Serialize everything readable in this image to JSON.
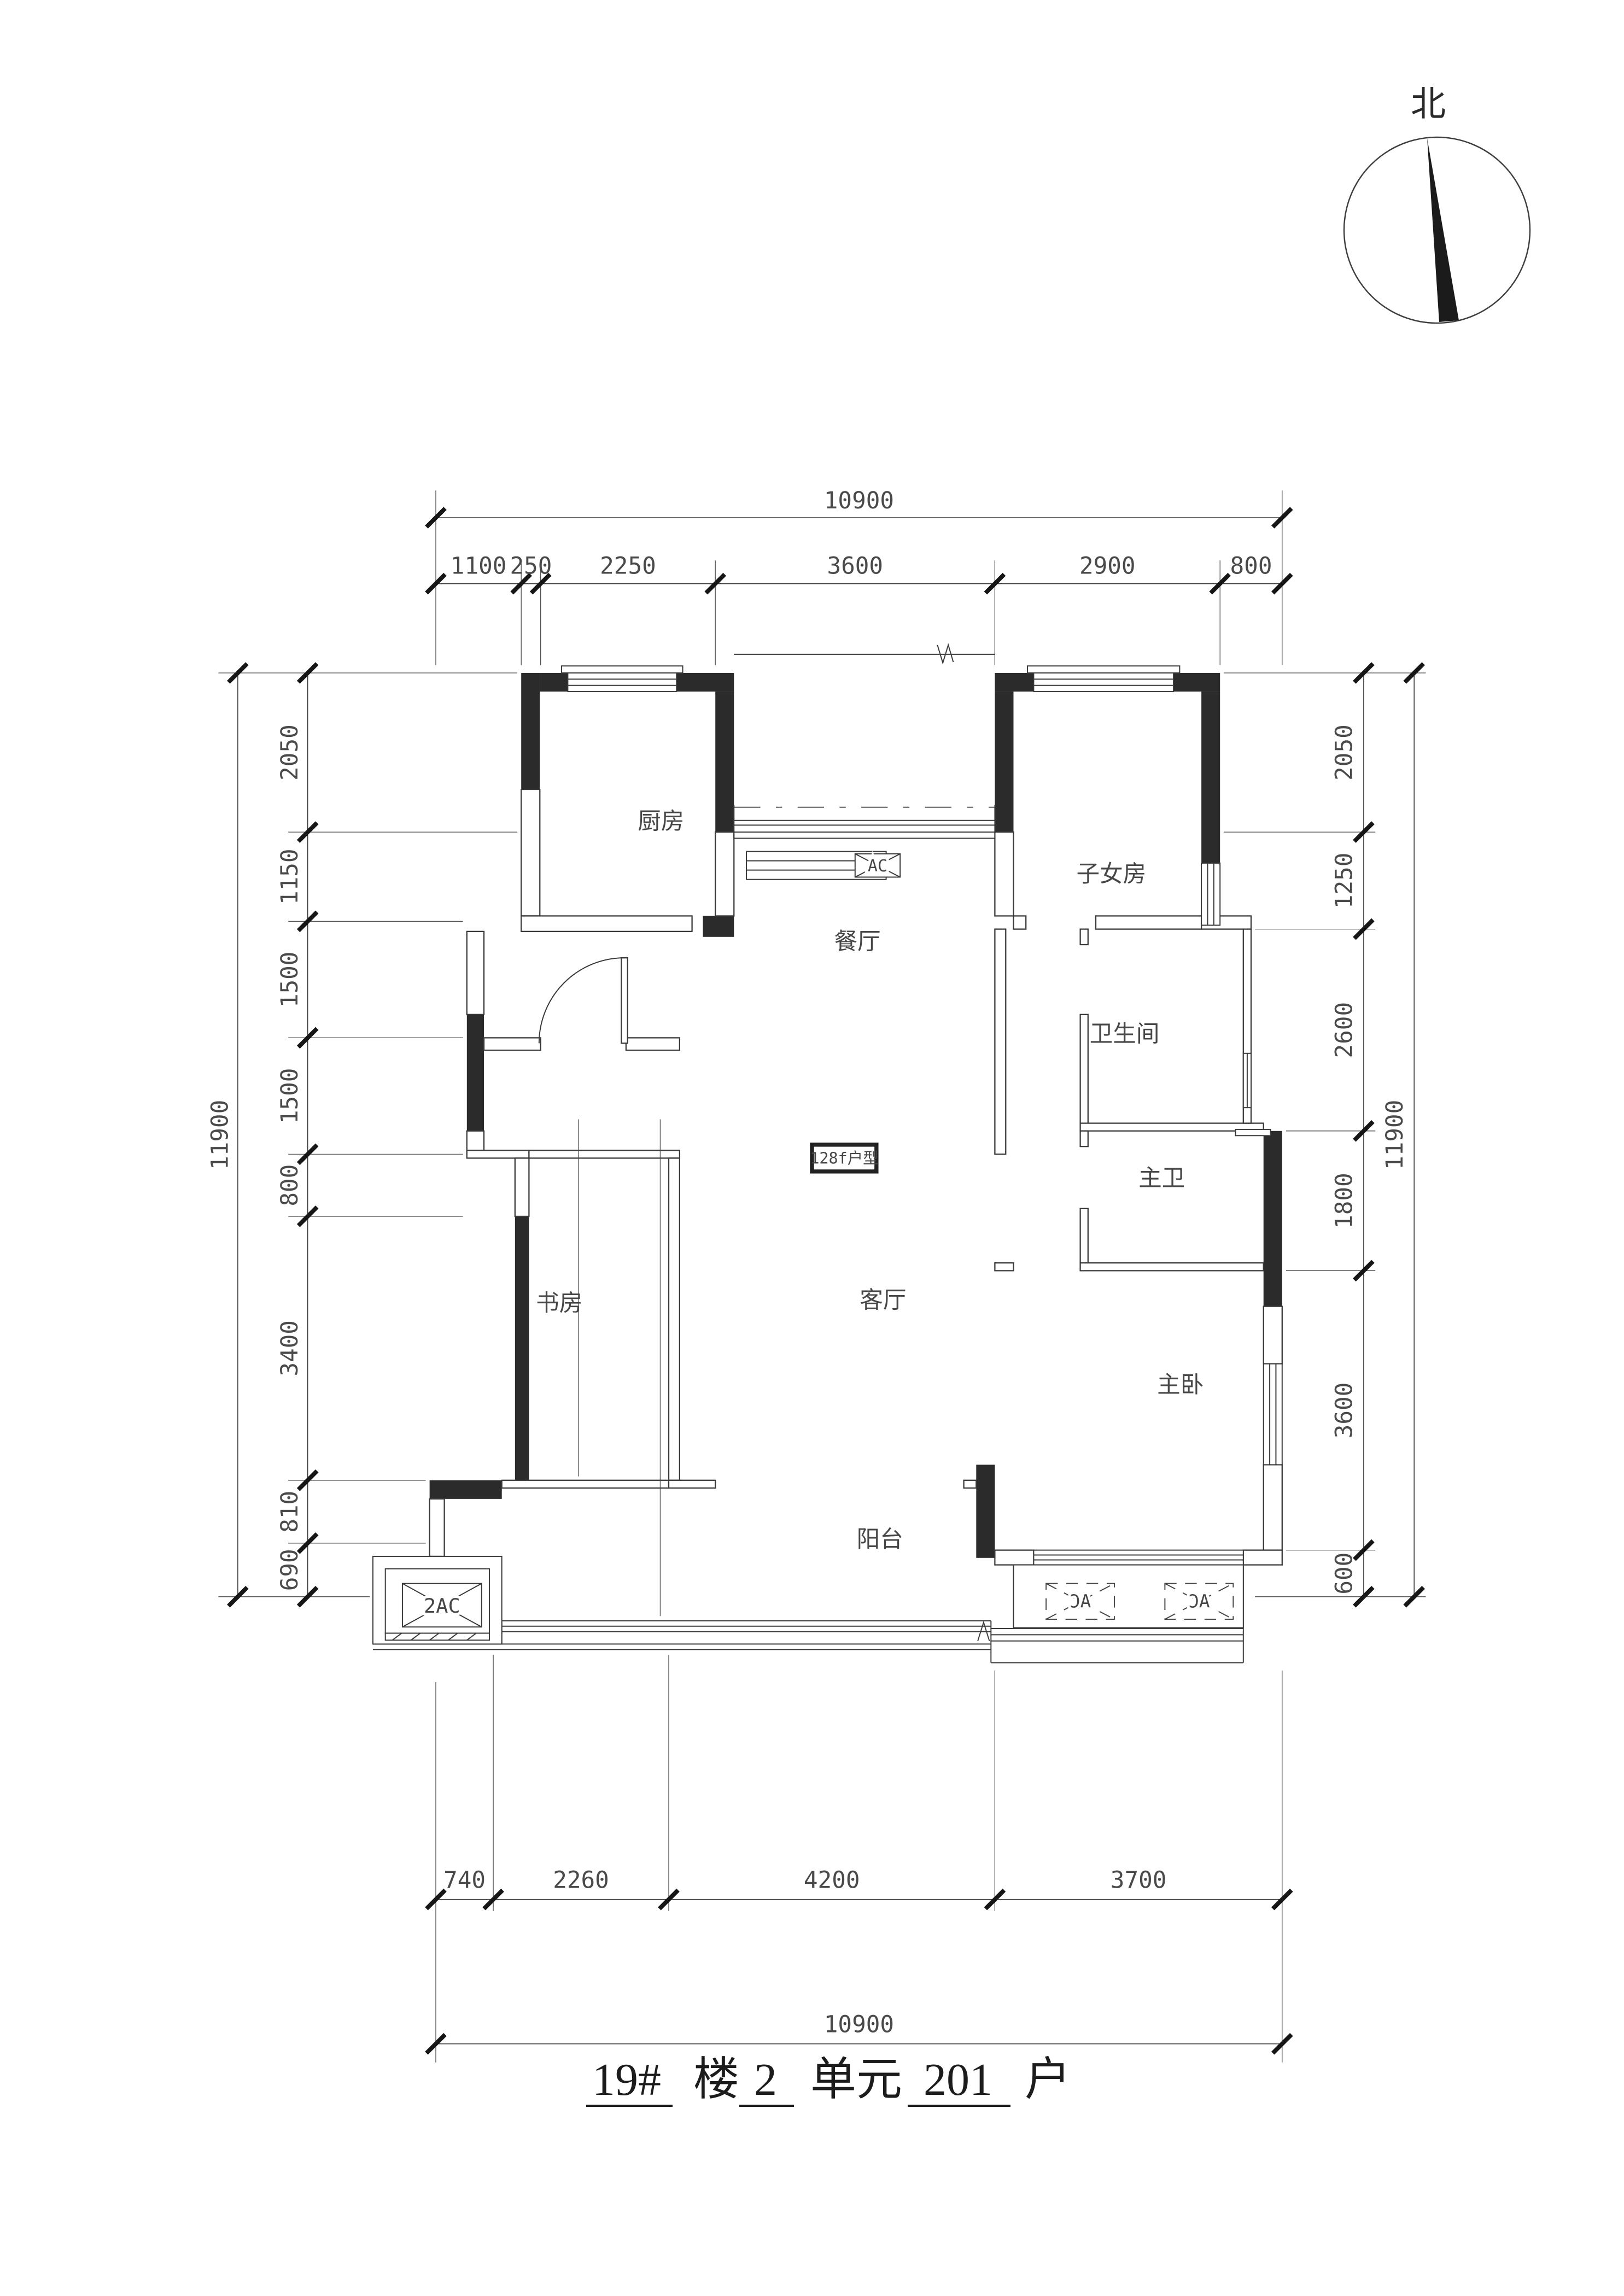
{
  "compass": {
    "north_label": "北"
  },
  "plan_label": {
    "text": "128f户型"
  },
  "rooms": {
    "kitchen": "厨房",
    "dining": "餐厅",
    "children_room": "子女房",
    "bathroom": "卫生间",
    "master_bath": "主卫",
    "study": "书房",
    "living": "客厅",
    "master_bedroom": "主卧",
    "balcony": "阳台"
  },
  "ac": {
    "dining_box": "AC",
    "southwest_box": "2AC",
    "bedroom_box_1": "AC",
    "bedroom_box_2": "AC"
  },
  "dimensions": {
    "top": {
      "total": "10900",
      "segments": [
        "1100",
        "250",
        "2250",
        "3600",
        "2900",
        "800"
      ]
    },
    "bottom": {
      "total": "10900",
      "segments": [
        "740",
        "2260",
        "4200",
        "3700"
      ]
    },
    "left": {
      "total": "11900",
      "segments": [
        "2050",
        "1150",
        "1500",
        "1500",
        "800",
        "3400",
        "810",
        "690"
      ]
    },
    "right": {
      "total": "11900",
      "segments": [
        "2050",
        "1250",
        "2600",
        "1800",
        "3600",
        "600"
      ]
    }
  },
  "title": {
    "building_no": "19#",
    "building_label": "楼",
    "unit_no": "2",
    "unit_label": "单元",
    "room_no": "201",
    "room_label": "户"
  }
}
